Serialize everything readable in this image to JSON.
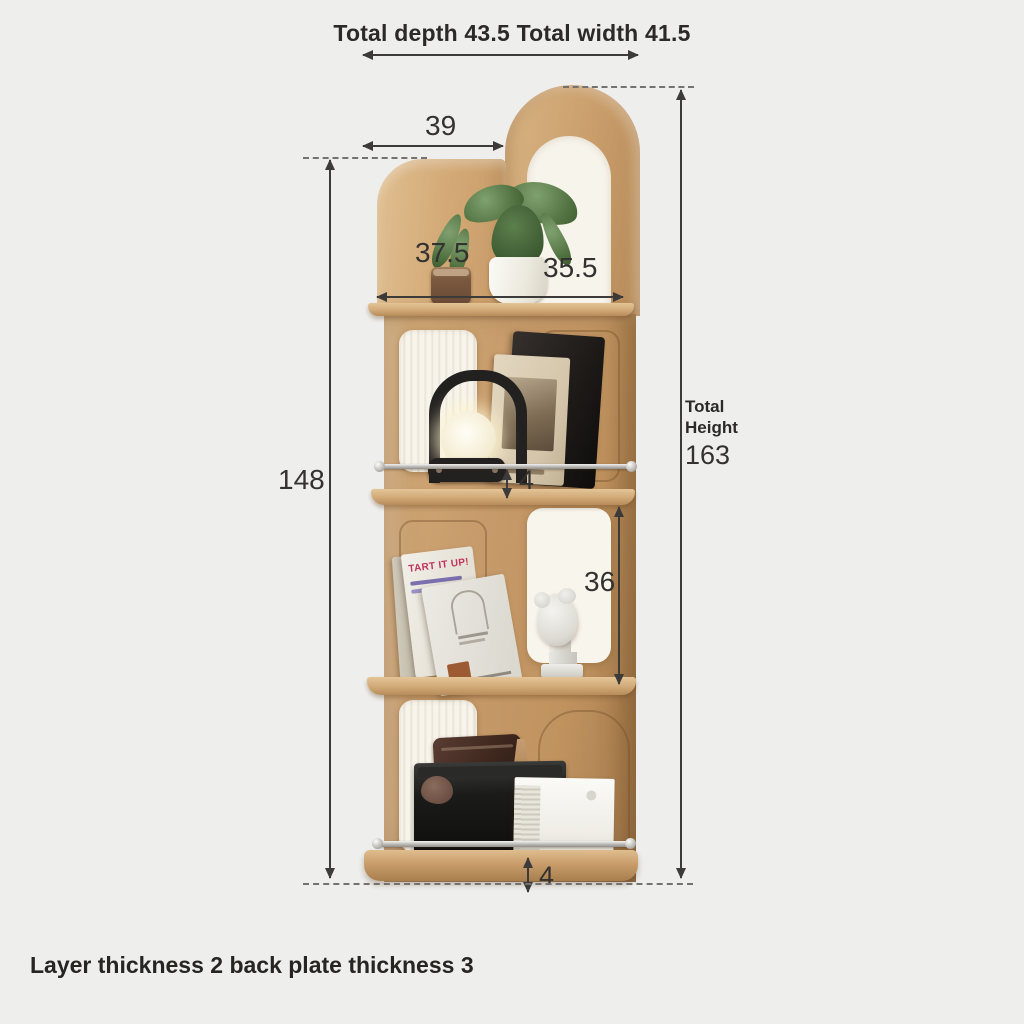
{
  "title": "Total depth 43.5 Total width 41.5",
  "footer": "Layer thickness 2 back plate thickness 3",
  "dimensions": {
    "top_span": "39",
    "shelf_depth_left": "37.5",
    "shelf_depth_right": "35.5",
    "left_height": "148",
    "rail_gap_upper": "4",
    "middle_section_height": "36",
    "base_height": "4",
    "total_height_label": "Total Height",
    "total_height_value": "163"
  },
  "objects": {
    "book_title": "TART IT UP!",
    "crate_label": "Totelife"
  },
  "colors": {
    "background": "#eeeeec",
    "wood": "#cba26f",
    "panel_white": "#f7f4ec",
    "ink": "#333230"
  }
}
